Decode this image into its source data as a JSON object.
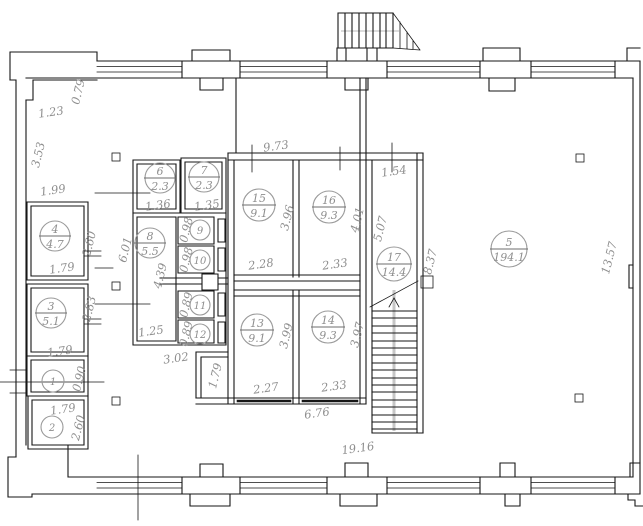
{
  "drawing": {
    "kind": "architectural-floor-plan",
    "colors": {
      "line": "#161616",
      "annotation": "#8e8e8e",
      "stair_rail": "#c6c6c6",
      "background": "#ffffff"
    }
  },
  "plan": {
    "rooms": [
      {
        "number": "1",
        "area": "",
        "cx": 53,
        "cy": 381,
        "r": 11
      },
      {
        "number": "2",
        "area": "",
        "cx": 52,
        "cy": 427,
        "r": 11
      },
      {
        "number": "3",
        "area": "5.1",
        "cx": 51,
        "cy": 313,
        "r": 15
      },
      {
        "number": "4",
        "area": "4.7",
        "cx": 55,
        "cy": 236,
        "r": 15
      },
      {
        "number": "5",
        "area": "194.1",
        "cx": 509,
        "cy": 249,
        "r": 18
      },
      {
        "number": "6",
        "area": "2.3",
        "cx": 160,
        "cy": 178,
        "r": 15
      },
      {
        "number": "7",
        "area": "2.3",
        "cx": 204,
        "cy": 177,
        "r": 15
      },
      {
        "number": "8",
        "area": "5.5",
        "cx": 150,
        "cy": 243,
        "r": 15
      },
      {
        "number": "9",
        "area": "",
        "cx": 200,
        "cy": 230,
        "r": 10
      },
      {
        "number": "10",
        "area": "",
        "cx": 200,
        "cy": 260,
        "r": 10
      },
      {
        "number": "11",
        "area": "",
        "cx": 200,
        "cy": 305,
        "r": 10
      },
      {
        "number": "12",
        "area": "",
        "cx": 200,
        "cy": 334,
        "r": 10
      },
      {
        "number": "13",
        "area": "9.1",
        "cx": 257,
        "cy": 330,
        "r": 16
      },
      {
        "number": "14",
        "area": "9.3",
        "cx": 328,
        "cy": 327,
        "r": 16
      },
      {
        "number": "15",
        "area": "9.1",
        "cx": 259,
        "cy": 205,
        "r": 16
      },
      {
        "number": "16",
        "area": "9.3",
        "cx": 329,
        "cy": 207,
        "r": 16
      },
      {
        "number": "17",
        "area": "14.4",
        "cx": 394,
        "cy": 264,
        "r": 17
      }
    ],
    "dimensions": [
      {
        "text": "0.79",
        "x": 79,
        "y": 92,
        "angle": -76
      },
      {
        "text": "1.23",
        "x": 51,
        "y": 113,
        "angle": -8
      },
      {
        "text": "3.53",
        "x": 39,
        "y": 155,
        "angle": -76
      },
      {
        "text": "1.99",
        "x": 53,
        "y": 191,
        "angle": -8
      },
      {
        "text": "2.60",
        "x": 90,
        "y": 244,
        "angle": -76
      },
      {
        "text": "1.79",
        "x": 62,
        "y": 269,
        "angle": -8
      },
      {
        "text": "2.83",
        "x": 90,
        "y": 309,
        "angle": -76
      },
      {
        "text": "1.79",
        "x": 60,
        "y": 352,
        "angle": -8
      },
      {
        "text": "0.90",
        "x": 80,
        "y": 379,
        "angle": -76
      },
      {
        "text": "1.79",
        "x": 63,
        "y": 410,
        "angle": -8
      },
      {
        "text": "2.60",
        "x": 79,
        "y": 428,
        "angle": -76
      },
      {
        "text": "6.01",
        "x": 126,
        "y": 250,
        "angle": -76
      },
      {
        "text": "1.36",
        "x": 158,
        "y": 206,
        "angle": -8
      },
      {
        "text": "1.35",
        "x": 207,
        "y": 206,
        "angle": -8
      },
      {
        "text": "0.98",
        "x": 187,
        "y": 230,
        "angle": -76
      },
      {
        "text": "0.98",
        "x": 187,
        "y": 260,
        "angle": -76
      },
      {
        "text": "0.89",
        "x": 187,
        "y": 305,
        "angle": -76
      },
      {
        "text": "0.89",
        "x": 187,
        "y": 334,
        "angle": -76
      },
      {
        "text": "4.39",
        "x": 161,
        "y": 276,
        "angle": -76
      },
      {
        "text": "1.25",
        "x": 151,
        "y": 332,
        "angle": -8
      },
      {
        "text": "3.02",
        "x": 176,
        "y": 359,
        "angle": -8
      },
      {
        "text": "9.73",
        "x": 276,
        "y": 147,
        "angle": -8
      },
      {
        "text": "1.54",
        "x": 394,
        "y": 172,
        "angle": -8
      },
      {
        "text": "3.96",
        "x": 288,
        "y": 218,
        "angle": -76
      },
      {
        "text": "4.01",
        "x": 358,
        "y": 220,
        "angle": -76
      },
      {
        "text": "5.07",
        "x": 381,
        "y": 229,
        "angle": -76
      },
      {
        "text": "8.37",
        "x": 431,
        "y": 262,
        "angle": -76
      },
      {
        "text": "2.28",
        "x": 261,
        "y": 265,
        "angle": -8
      },
      {
        "text": "2.33",
        "x": 335,
        "y": 265,
        "angle": -8
      },
      {
        "text": "13.57",
        "x": 610,
        "y": 258,
        "angle": -76
      },
      {
        "text": "3.99",
        "x": 287,
        "y": 336,
        "angle": -76
      },
      {
        "text": "3.97",
        "x": 358,
        "y": 335,
        "angle": -76
      },
      {
        "text": "1.79",
        "x": 216,
        "y": 376,
        "angle": -76
      },
      {
        "text": "2.27",
        "x": 266,
        "y": 389,
        "angle": -8
      },
      {
        "text": "2.33",
        "x": 334,
        "y": 387,
        "angle": -8
      },
      {
        "text": "6.76",
        "x": 317,
        "y": 414,
        "angle": -8
      },
      {
        "text": "19.16",
        "x": 358,
        "y": 449,
        "angle": -8
      }
    ]
  }
}
